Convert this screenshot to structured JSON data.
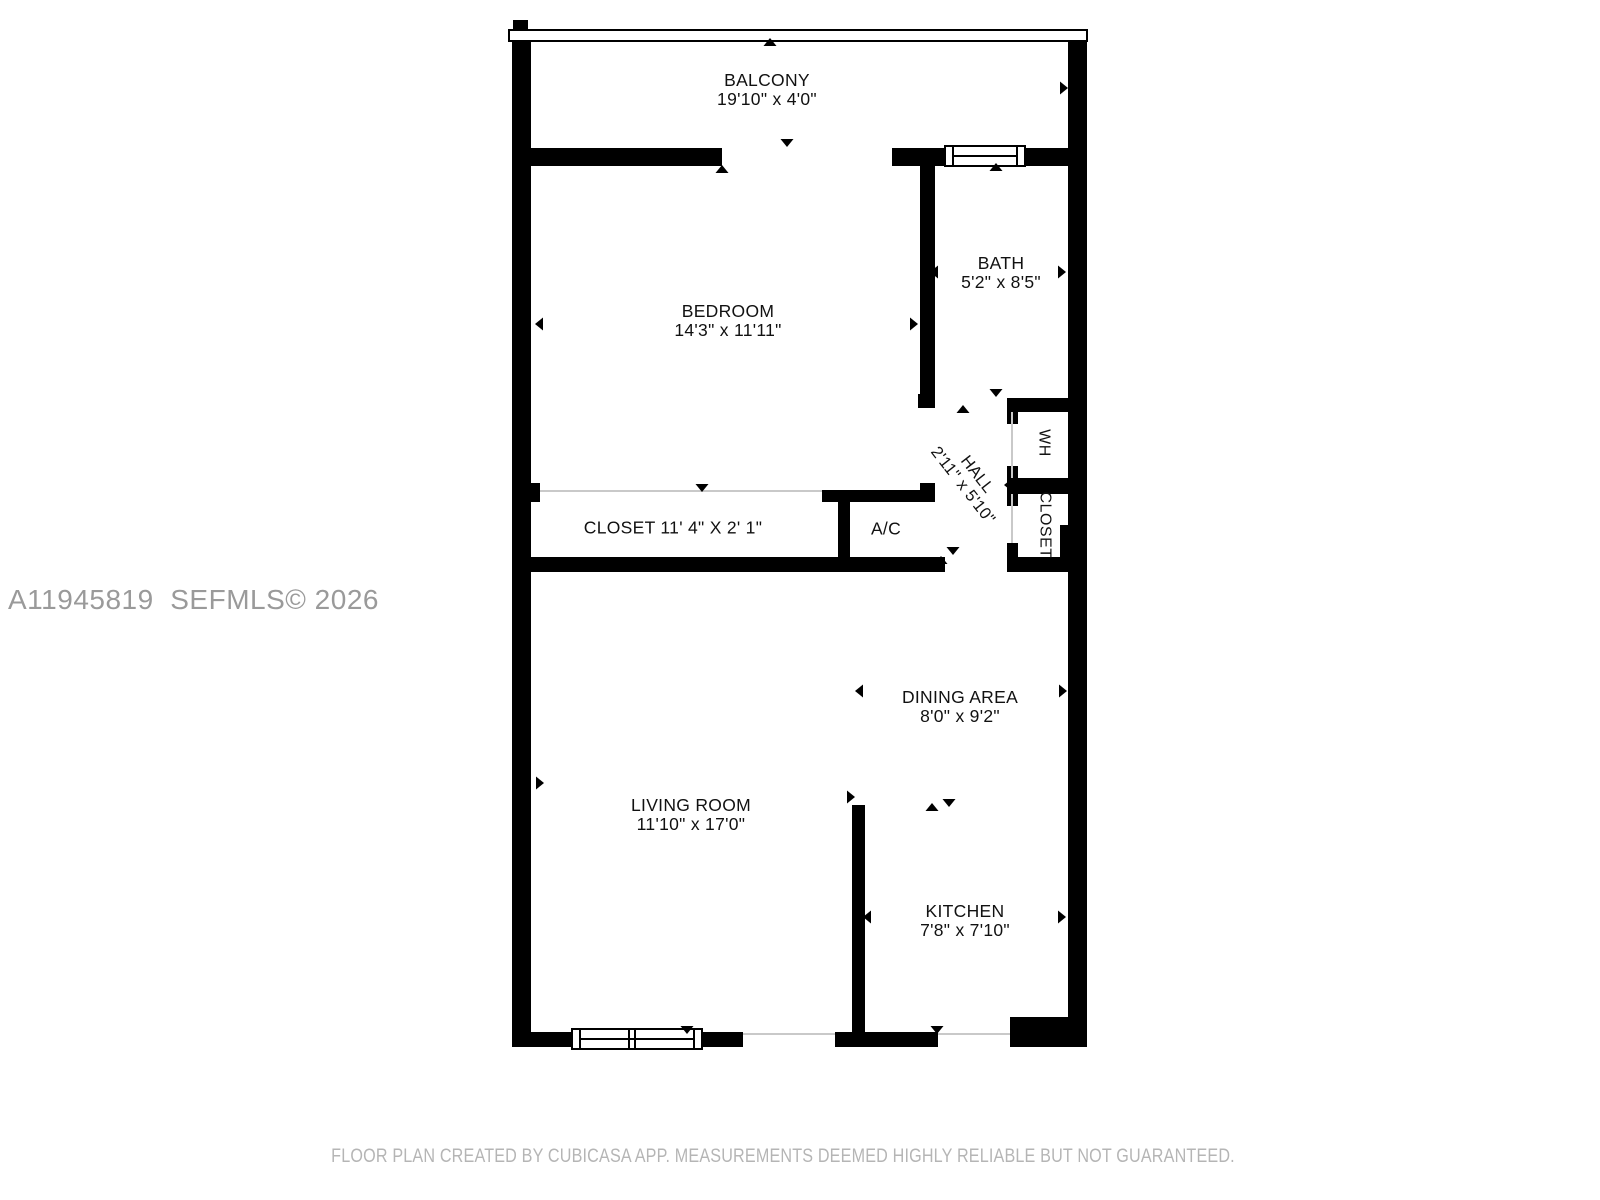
{
  "watermark": "A11945819  SEFMLS© 2026",
  "footer": "FLOOR PLAN CREATED BY CUBICASA APP. MEASUREMENTS DEEMED HIGHLY RELIABLE BUT NOT GUARANTEED.",
  "rooms": {
    "balcony": {
      "name": "BALCONY",
      "dims": "19'10\" x 4'0\""
    },
    "bedroom": {
      "name": "BEDROOM",
      "dims": "14'3\" x 11'11\""
    },
    "bath": {
      "name": "BATH",
      "dims": "5'2\" x 8'5\""
    },
    "hall": {
      "name": "HALL",
      "dims": "2'11\" x 5'10\""
    },
    "wh": {
      "name": "WH"
    },
    "hall_closet": {
      "name": "CLOSET"
    },
    "bedroom_closet": {
      "name": "CLOSET 11' 4\" X 2' 1\""
    },
    "ac": {
      "name": "A/C"
    },
    "dining": {
      "name": "DINING AREA",
      "dims": "8'0\" x 9'2\""
    },
    "living": {
      "name": "LIVING ROOM",
      "dims": "11'10\" x 17'0\""
    },
    "kitchen": {
      "name": "KITCHEN",
      "dims": "7'8\" x 7'10\""
    }
  },
  "colors": {
    "wall": "#000000",
    "watermark_text": "#9a9a9a",
    "footer_text": "#b5b5b5",
    "opening_line": "#c9c9c9",
    "background": "#ffffff"
  }
}
